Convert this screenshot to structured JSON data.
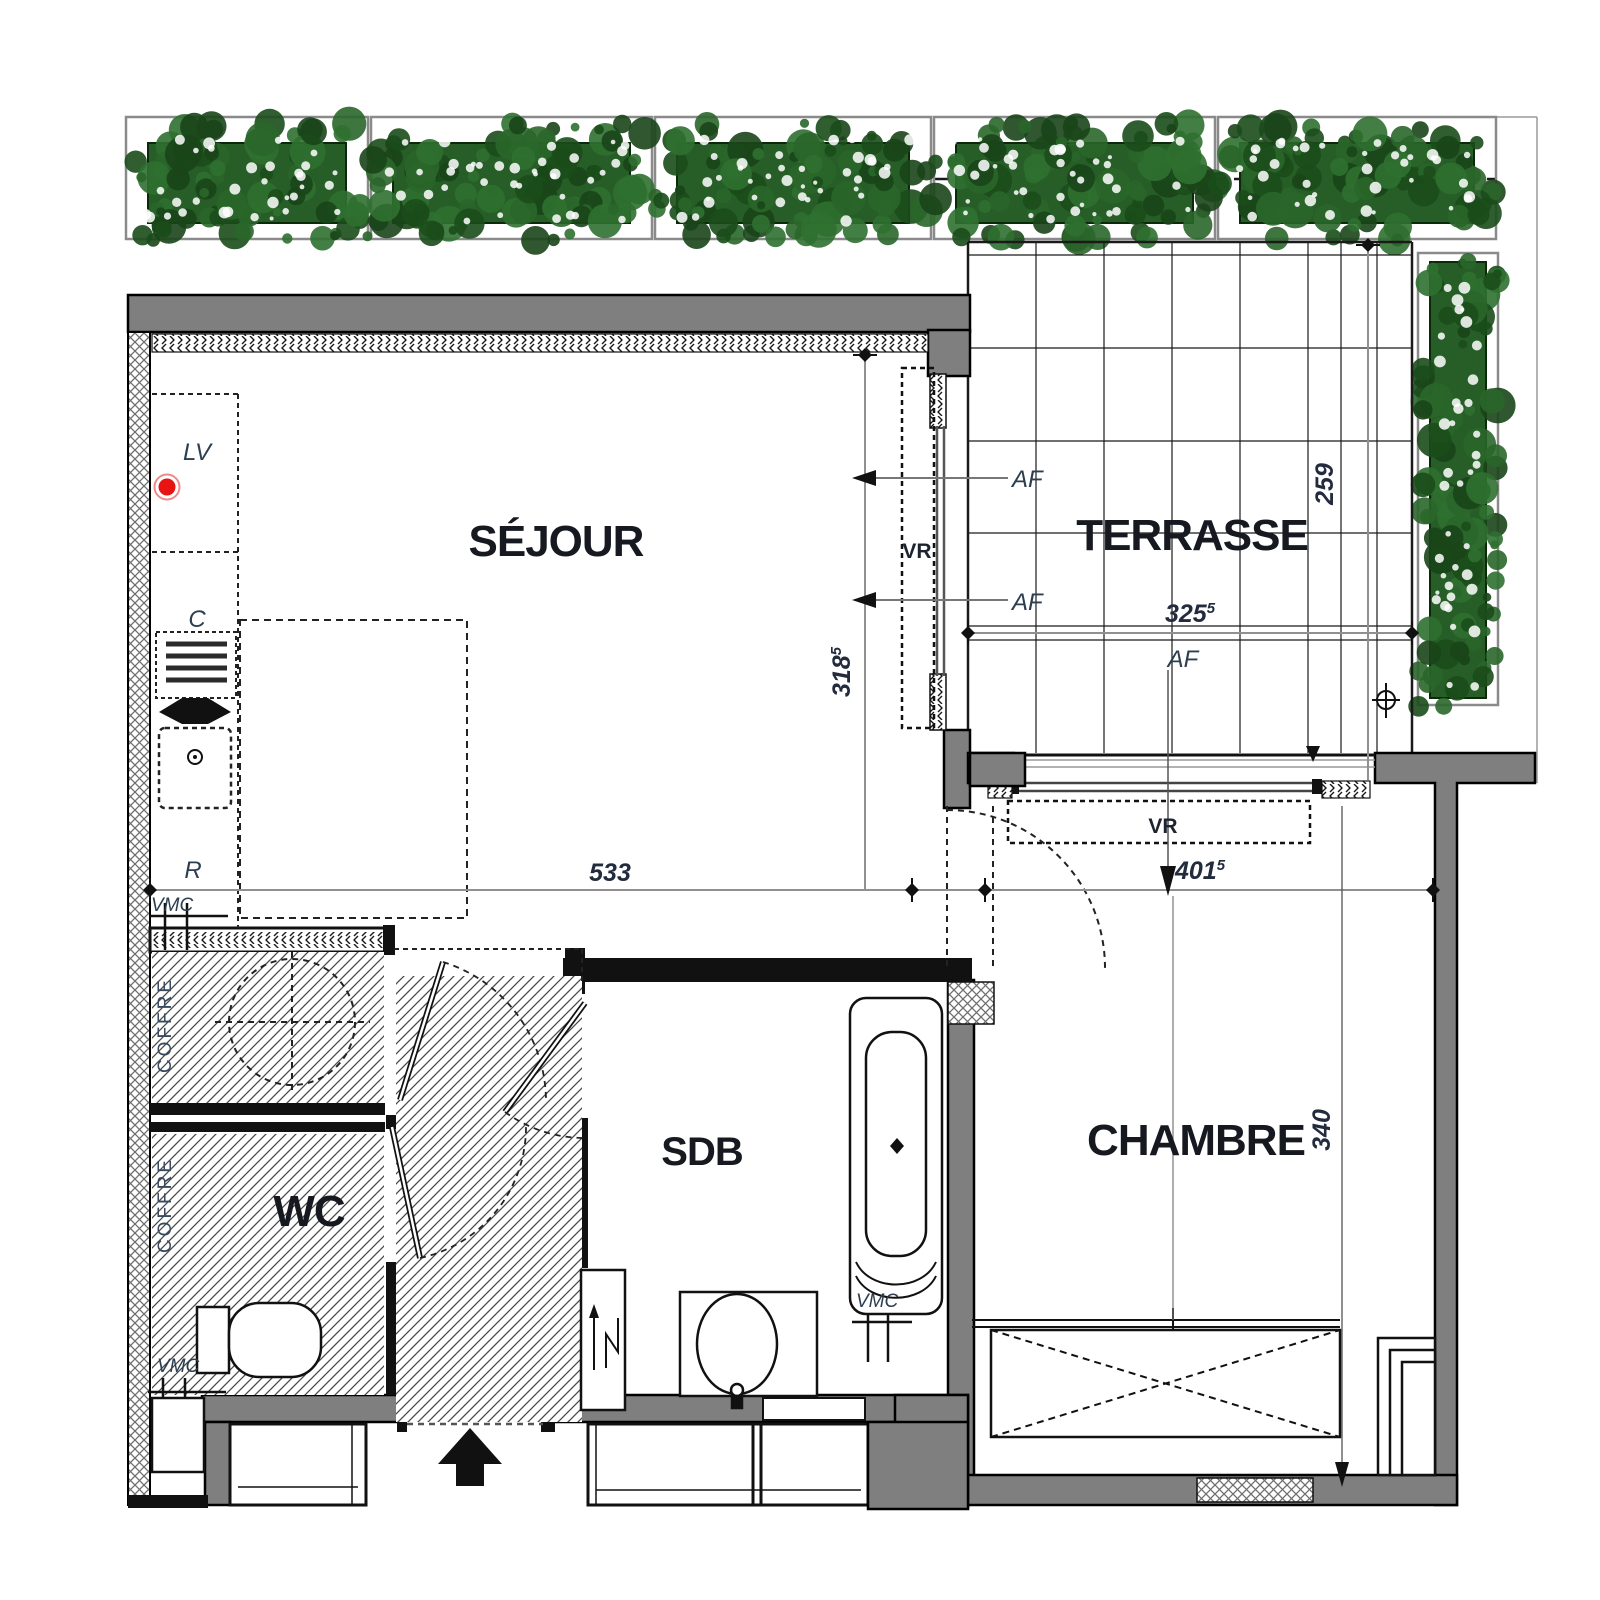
{
  "page": {
    "background": "#ffffff"
  },
  "colors": {
    "wall_fill": "#7f7f7f",
    "partition": "#111111",
    "plant_dark": "#1b4d1b",
    "plant_mid": "#2a662a",
    "red_dot": "#e81313",
    "dim_line": "#909090",
    "label_dark": "#16191f",
    "annot_blue": "#2c3e50"
  },
  "rooms": {
    "sejour": "SÉJOUR",
    "terrasse": "TERRASSE",
    "chambre": "CHAMBRE",
    "wc": "WC",
    "sdb": "SDB"
  },
  "annotations": {
    "lv": "LV",
    "c": "C",
    "r": "R",
    "vmc": "VMC",
    "vr": "VR",
    "af": "AF",
    "coffre": "COFFRE"
  },
  "dimensions": {
    "sejour_width": {
      "value": "533",
      "sup": ""
    },
    "sejour_depth": {
      "value": "318",
      "sup": "5"
    },
    "terrasse_width": {
      "value": "325",
      "sup": "5"
    },
    "terrasse_depth": {
      "value": "259",
      "sup": ""
    },
    "chambre_width": {
      "value": "401",
      "sup": "5"
    },
    "chambre_depth": {
      "value": "340",
      "sup": ""
    }
  }
}
